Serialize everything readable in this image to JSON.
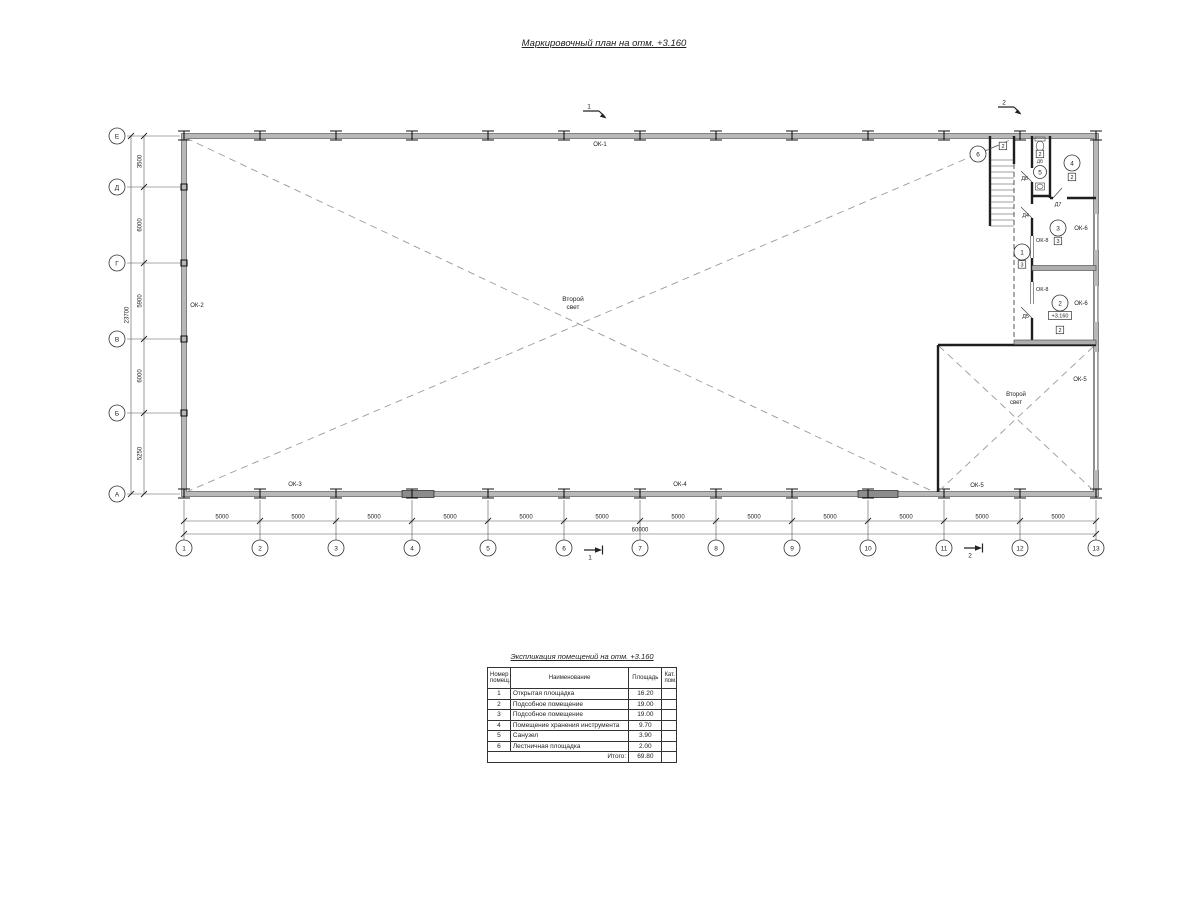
{
  "drawing_title": "Маркировочный план на отм. +3.160",
  "plan": {
    "grid": {
      "cols": [
        "1",
        "2",
        "3",
        "4",
        "5",
        "6",
        "7",
        "8",
        "9",
        "10",
        "11",
        "12",
        "13"
      ],
      "rows": [
        "Е",
        "Д",
        "Г",
        "В",
        "Б",
        "А"
      ],
      "col_dims": [
        "5000",
        "5000",
        "5000",
        "5000",
        "5000",
        "5000",
        "5000",
        "5000",
        "5000",
        "5000",
        "5000",
        "5000"
      ],
      "row_dims": [
        "3500",
        "6000",
        "5900",
        "6000",
        "5250"
      ],
      "col_total": "60000",
      "row_total": "23700"
    },
    "windows": {
      "ok1": "ОК-1",
      "ok2": "ОК-2",
      "ok3": "ОК-3",
      "ok4": "ОК-4",
      "ok5": "ОК-5",
      "ok6": "ОК-6",
      "ok8": "ОК-8"
    },
    "doors": {
      "d4": "Д4",
      "d5": "Д5",
      "d7": "Д7",
      "d8": "Д8",
      "dv": "ДВ"
    },
    "rooms": [
      {
        "num": "1",
        "tag": "3"
      },
      {
        "num": "2",
        "tag": "2"
      },
      {
        "num": "3",
        "tag": "3"
      },
      {
        "num": "4",
        "tag": "2"
      },
      {
        "num": "5",
        "tag": "2"
      },
      {
        "num": "6",
        "tag": "2"
      }
    ],
    "level_mark": "+3.160",
    "second_light": {
      "line1": "Второй",
      "line2": "свет"
    },
    "sections": {
      "s1": "1",
      "s2": "2"
    }
  },
  "table": {
    "title": "Экспликация помещений на отм. +3.160",
    "headers": {
      "num": "Номер помещ.",
      "name": "Наименование",
      "area": "Площадь",
      "cat": "Кат. пом."
    },
    "rows": [
      {
        "num": "1",
        "name": "Открытая площадка",
        "area": "16.20",
        "cat": ""
      },
      {
        "num": "2",
        "name": "Подсобное помещение",
        "area": "19.00",
        "cat": ""
      },
      {
        "num": "3",
        "name": "Подсобное помещение",
        "area": "19.00",
        "cat": ""
      },
      {
        "num": "4",
        "name": "Помещение хранения инструмента",
        "area": "9.70",
        "cat": ""
      },
      {
        "num": "5",
        "name": "Санузел",
        "area": "3.90",
        "cat": ""
      },
      {
        "num": "6",
        "name": "Лестничная площадка",
        "area": "2.00",
        "cat": ""
      }
    ],
    "total_label": "Итого:",
    "total_value": "69.80"
  }
}
